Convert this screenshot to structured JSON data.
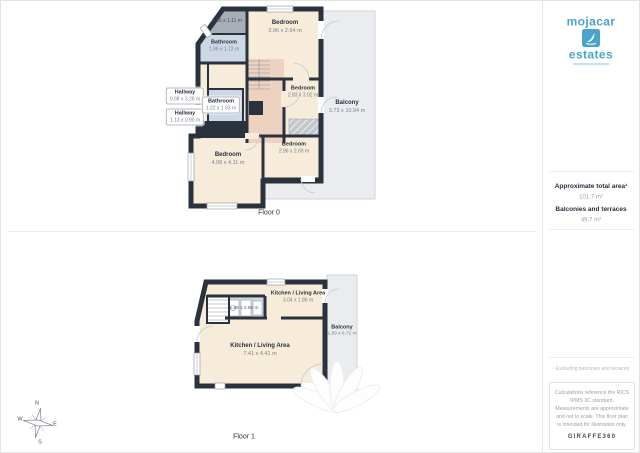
{
  "branding": {
    "logo_top": "mojacar",
    "logo_bottom": "estates"
  },
  "sidebar": {
    "area_title": "Approximate total area¹",
    "area_value": "101.7 m²",
    "terrace_title": "Balconies and terraces",
    "terrace_value": "49.7 m²",
    "footnote": "¹ Excluding balconies and terraces",
    "disclaimer": "Calculations reference the RICS IPMS 3C standard. Measurements are approximate and not to scale. This floor plan is intended for illustration only.",
    "provider": "GIRAFFE360"
  },
  "compass": {
    "n": "N",
    "e": "E",
    "s": "S",
    "w": "W"
  },
  "floor0": {
    "label": "Floor 0",
    "rooms": {
      "storage_dims": "1.86 x 1.11 m",
      "bathroom_tl": {
        "name": "Bathroom",
        "dims": "1.96 x 1.72 m"
      },
      "bedroom_top": {
        "name": "Bedroom",
        "dims": "3.96 x 2.94 m"
      },
      "hallway_1": {
        "name": "Hallway",
        "dims": "0.98 x 3.26 m"
      },
      "hallway_2": {
        "name": "Hallway",
        "dims": "1.13 x 0.90 m"
      },
      "bathroom_mid": {
        "name": "Bathroom",
        "dims": "1.22 x 1.93 m"
      },
      "bedroom_mid": {
        "name": "Bedroom",
        "dims": "2.83 x 3.92 m"
      },
      "balcony": {
        "name": "Balcony",
        "dims": "3.73 x 10.94 m"
      },
      "bedroom_bl": {
        "name": "Bedroom",
        "dims": "4.08 x 4.11 m"
      },
      "bedroom_bc": {
        "name": "Bedroom",
        "dims": "2.96 x 2.69 m"
      }
    }
  },
  "floor1": {
    "label": "Floor 1",
    "rooms": {
      "kitchen_top": {
        "name": "Kitchen / Living Area",
        "dims": "3.04 x 1.86 m"
      },
      "kitchen_strip_dims": "1.96 x 0.86 m",
      "living_main": {
        "name": "Kitchen / Living Area",
        "dims": "7.41 x 4.41 m"
      },
      "balcony": {
        "name": "Balcony",
        "dims": "1.89 x 6.72 m"
      }
    }
  }
}
